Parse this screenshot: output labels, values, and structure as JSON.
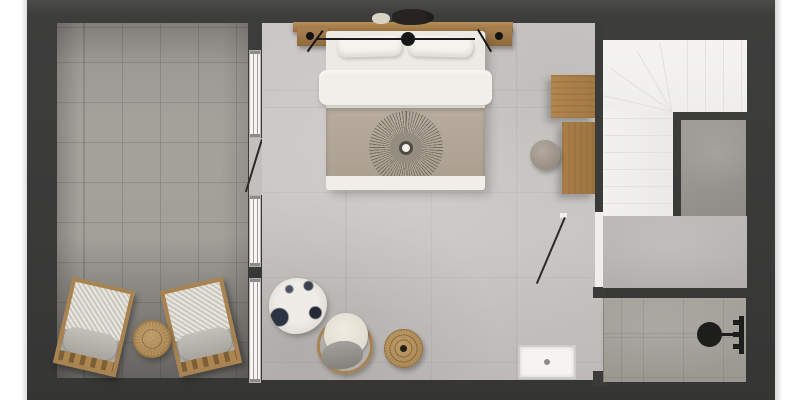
{
  "meta": {
    "type": "3d-floor-plan-render",
    "description": "Top-down 3D rendered floor plan of a studio bedroom apartment with terrace, winder staircase and shower room",
    "page_background": "#ffffff",
    "wall_color": "#3c3c3b"
  },
  "rooms": {
    "terrace": {
      "label": "Tiled terrace with two lounge chairs and side table",
      "floor_color": "#a29e98"
    },
    "bedroom": {
      "label": "Bedroom with concrete-look floor",
      "floor_color": "#c7c4c1"
    },
    "stairs": {
      "label": "White winder staircase",
      "floor_color": "#f3f2f0"
    },
    "landing": {
      "label": "Concrete landing beside staircase",
      "floor_color": "#9c9995"
    },
    "hallway": {
      "label": "Hallway at foot of stairs",
      "floor_color": "#bbb8b5"
    },
    "bathroom": {
      "label": "Tiled shower room",
      "floor_color": "#a5a19b"
    }
  },
  "architecture": {
    "window_wall": {
      "label": "Glazed wall with three window sections between terrace and bedroom",
      "frame_color": "#f6f5f3"
    },
    "terrace_door": {
      "label": "Open door from terrace to bedroom with swing line"
    },
    "hall_door": {
      "label": "Open door from bedroom to hallway with swing line"
    }
  },
  "furniture": {
    "bed": {
      "label": "Double bed with white duvet, two pillows, taupe throw with sunburst medallion"
    },
    "headboard_shelf": {
      "label": "Wooden headboard shelf with plant and vase decor"
    },
    "nightstand_left": {
      "label": "Left wooden nightstand with black lamp"
    },
    "nightstand_right": {
      "label": "Right wooden nightstand with black lamp"
    },
    "desk": {
      "label": "Two-tier wooden desk against stair wall"
    },
    "desk_stool": {
      "label": "Round upholstered stool"
    },
    "rug": {
      "label": "Round abstract shag rug, cream with navy patches"
    },
    "barrel_chair": {
      "label": "Barrel chair with cream boucle seat and gray cushion"
    },
    "jute_table": {
      "label": "Round jute/wood side table with center dot"
    },
    "shower_tray": {
      "label": "White rectangular shower tray with drain"
    },
    "shower_set": {
      "label": "Black wall-mounted shower head and mixer"
    },
    "lounge_chair_left": {
      "label": "Wooden lounge chair with gray cushions (left)"
    },
    "lounge_chair_right": {
      "label": "Wooden lounge chair with gray cushions (right)"
    },
    "terrace_table": {
      "label": "Round rattan coffee table"
    }
  }
}
